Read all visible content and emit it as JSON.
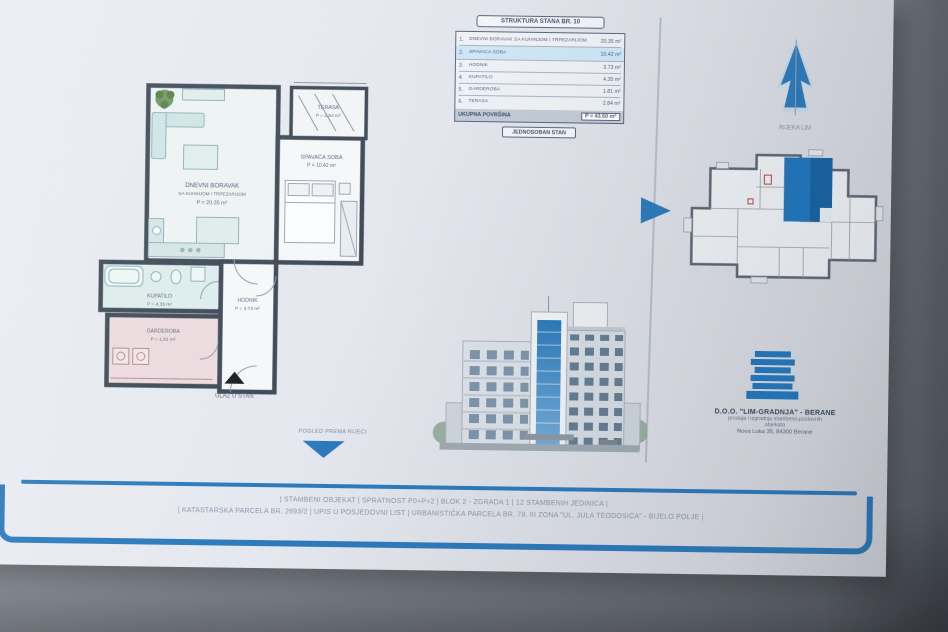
{
  "table": {
    "header": "STRUKTURA STANA BR. 10",
    "rows": [
      {
        "num": "1.",
        "name": "DNEVNI BORAVAK SA KUHINJOM I TRPEZARIJOM",
        "area": "20.35 m²"
      },
      {
        "num": "2.",
        "name": "SPAVAĆA SOBA",
        "area": "10.42 m²"
      },
      {
        "num": "3.",
        "name": "HODNIK",
        "area": "3.73 m²"
      },
      {
        "num": "4.",
        "name": "KUPATILO",
        "area": "4.35 m²"
      },
      {
        "num": "5.",
        "name": "GARDEROBA",
        "area": "1.81 m²"
      },
      {
        "num": "6.",
        "name": "TERASA",
        "area": "2.84 m²"
      }
    ],
    "total_label": "UKUPNA POVRŠINA",
    "total_value": "P = 43.50 m²",
    "footer_box": "JEDNOSOBAN STAN"
  },
  "floorplan": {
    "labels": {
      "living_1": "DNEVNI BORAVAK",
      "living_2": "SA KUHINJOM I TRPEZARIJOM",
      "living_area": "P = 20.35 m²",
      "bedroom": "SPAVAĆA SOBA",
      "bedroom_area": "P = 10.42 m²",
      "terrace": "TERASA",
      "terrace_area": "P = 2.84 m²",
      "bath": "KUPATILO",
      "bath_area": "P = 4.35 m²",
      "wardrobe": "GARDEROBA",
      "wardrobe_area": "P = 1.81 m²",
      "hall": "HODNIK",
      "hall_area": "P = 3.73 m²",
      "entrance": "ULAZ U STAN",
      "view": "POGLED PREMA RIJECI"
    }
  },
  "north": {
    "label": "RIJEKA LIM"
  },
  "company": {
    "name": "D.O.O. \"LIM-GRADNJA\" - BERANE",
    "line2": "prodaja i izgradnja stambeno-poslovnih",
    "line3": "objekata",
    "line4": "Nova Luka 35, 84300 Berane"
  },
  "footer": {
    "line1": "| STAMBENI OBJEKAT | SPRATNOST P0+P+2 | BLOK 2 - ZGRADA 1 | 12 STAMBENIH JEDINICA |",
    "line2": "| KATASTARSKA PARCELA BR. 2693/2 | UPIS U POSJEDOVNI LIST | URBANISTIČKA PARCELA BR. 78, III ZONA \"UL. JULA TEODOSIĆA\" - BIJELO POLJE |"
  },
  "side_note": "STAMBENI OBJEKAT - BERANE",
  "colors": {
    "accent_blue": "#2a7cc0",
    "highlight_unit": "#1d79c2",
    "table_highlight_row": "#cde6f7",
    "paper": "#e5e8ef",
    "wall": "#3e4b58",
    "teal_room": "#dcecec",
    "pink_room": "#eddbde"
  }
}
